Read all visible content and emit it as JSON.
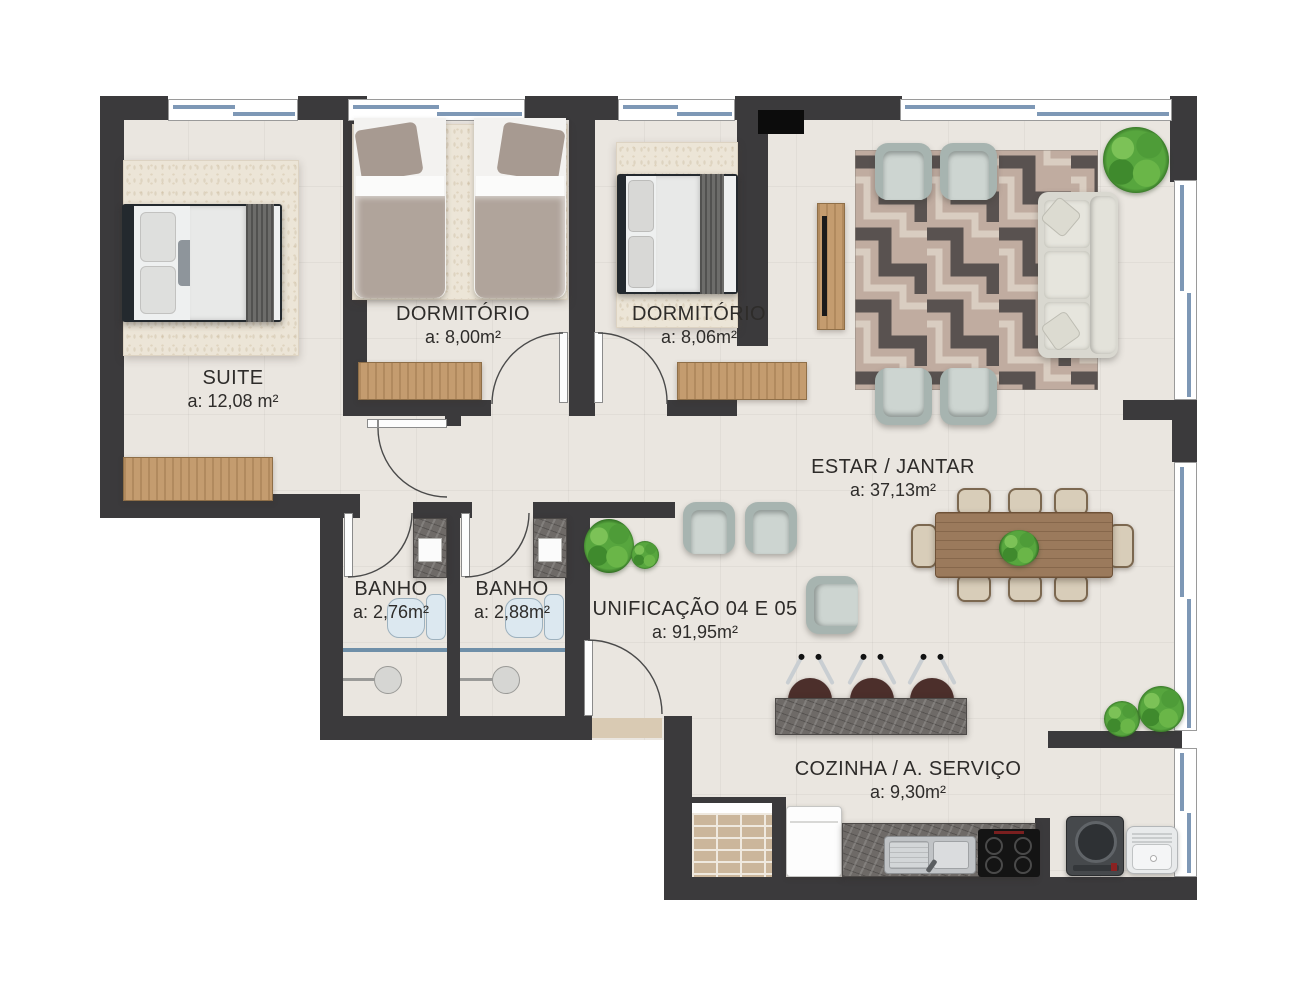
{
  "plan": {
    "rooms": {
      "suite": {
        "name": "SUITE",
        "area": "a: 12,08 m²"
      },
      "dormitorio1": {
        "name": "DORMITÓRIO",
        "area": "a: 8,00m²"
      },
      "dormitorio2": {
        "name": "DORMITÓRIO",
        "area": "a: 8,06m²"
      },
      "banho1": {
        "name": "BANHO",
        "area": "a: 2,76m²"
      },
      "banho2": {
        "name": "BANHO",
        "area": "a: 2,88m²"
      },
      "unificacao": {
        "name": "UNIFICAÇÃO 04 E 05",
        "area": "a: 91,95m²"
      },
      "estar_jantar": {
        "name": "ESTAR / JANTAR",
        "area": "a: 37,13m²"
      },
      "cozinha": {
        "name": "COZINHA / A. SERVIÇO",
        "area": "a: 9,30m²"
      }
    },
    "colors": {
      "wall": "#3b3a3c",
      "floor": "#eae6e0",
      "glazing": "#7e98b6",
      "wood": "#c49c6f",
      "rug_dark": "#595250",
      "rug_light": "#c0aca0",
      "text": "#2e2c2a"
    }
  }
}
